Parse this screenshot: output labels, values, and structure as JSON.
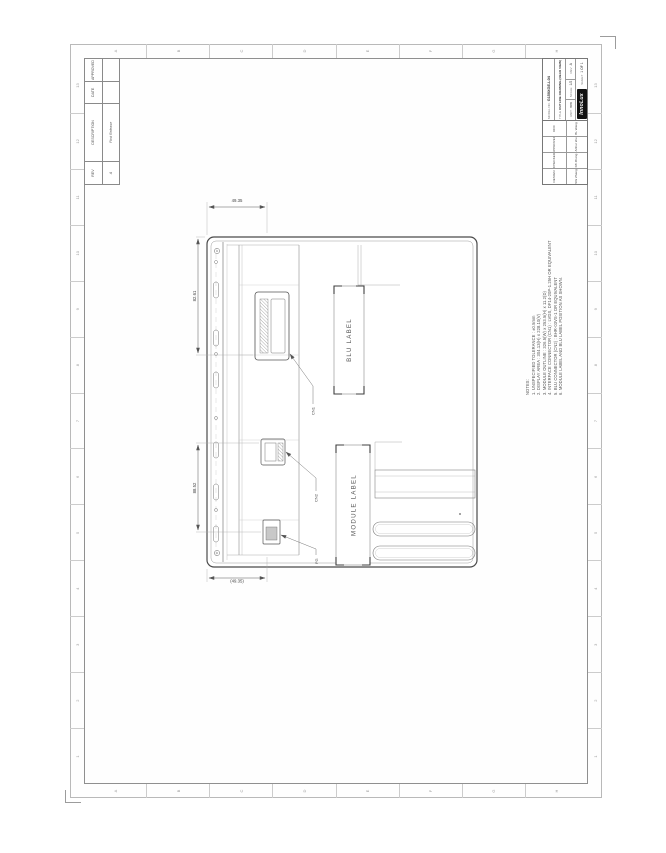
{
  "sheet": {
    "zones": {
      "numbers": [
        "1",
        "2",
        "3",
        "4",
        "5",
        "6",
        "7",
        "8",
        "9",
        "10",
        "11",
        "12",
        "13"
      ],
      "letters": [
        "A",
        "B",
        "C",
        "D",
        "E",
        "F",
        "G",
        "H"
      ]
    },
    "revision_table": {
      "headers": [
        "REV",
        "DESCRIPTION",
        "DATE",
        "APPROVED"
      ],
      "rows": [
        [
          "A",
          "First Release",
          "",
          ""
        ]
      ]
    },
    "title_block": {
      "signoff": [
        {
          "role": "DESIGN",
          "name": "SW Zhang"
        },
        {
          "role": "CHECKED",
          "name": "KB Zheng"
        },
        {
          "role": "APPROVED",
          "name": "Arthur Wu"
        },
        {
          "role": "DCC",
          "name": "BL Wang"
        }
      ],
      "model_label": "MODEL NO.",
      "model": "G150XGE-L04",
      "title_label": "TITLE",
      "title": "OUTLINE DRAWING (REAR VIEW)",
      "unit_label": "UNIT",
      "unit": "mm",
      "scale_label": "SCALE",
      "scale": "1/2",
      "rev_label": "REV",
      "rev": "A",
      "logo": "InnoLux",
      "sheet_label": "SHEET",
      "sheet_value": "1 OF 1"
    },
    "notes": {
      "lines": [
        "NOTES:",
        "1. UNSPECIFIED TOLERANCE : ±0.5mm",
        "2. DISPLAY AREA : 304.13(H) x 228.10(V)",
        "3. MODULE OUTLINE : 326.5(W) x 253.5(H) x 11.2(D)",
        "4. INTERFACE CONNECTOR (CN1) : LVDS, DF14-20P-1.25H OR EQUIVALENT",
        "5. BLU CONNECTOR (CN2) : BHR-03VS-1 OR EQUIVALENT",
        "6. MODULE LABEL AND BLU LABEL POSITION AS SHOWN."
      ]
    },
    "drawing": {
      "module_label": "MODULE  LABEL",
      "blu_label": "BLU  LABEL",
      "dims": {
        "a": "49.35",
        "b": "82.61",
        "c": "88.52",
        "d": "(49.35)"
      },
      "leaders": {
        "l1": "CN1",
        "l2": "CN2",
        "l3": "FG"
      }
    }
  }
}
